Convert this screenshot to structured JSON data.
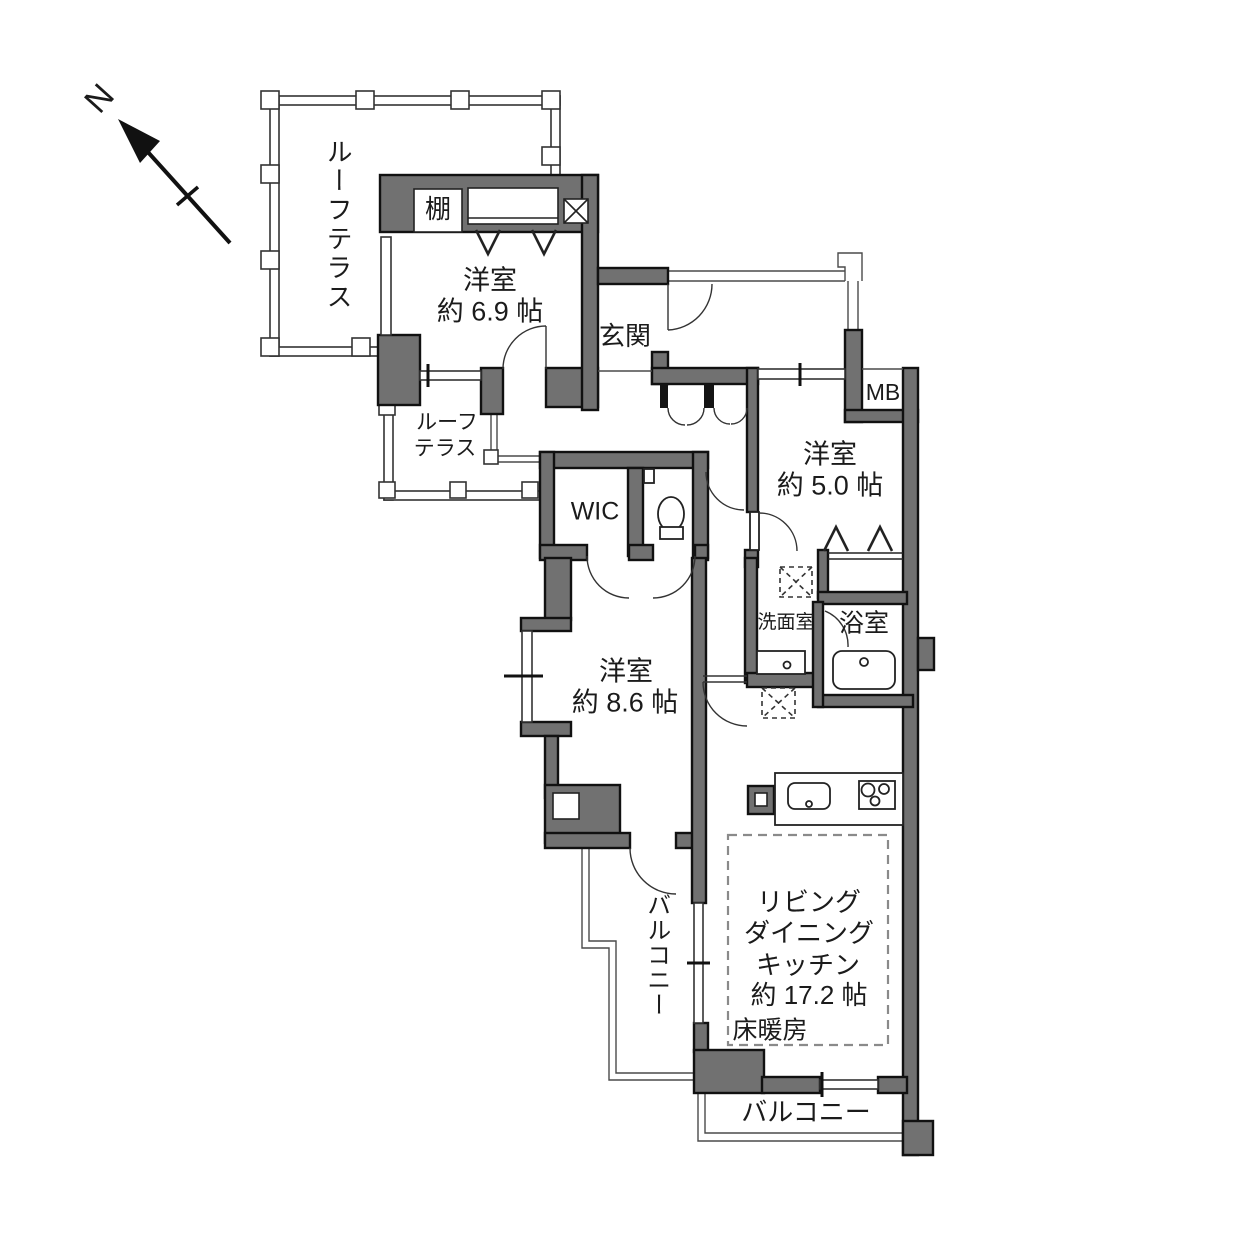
{
  "compass": {
    "north_label": "N"
  },
  "rooms": {
    "roof_terrace_main": {
      "label": "ルーフテラス"
    },
    "shelf": {
      "label": "棚"
    },
    "bedroom_69": {
      "name": "洋室",
      "area": "約 6.9 帖"
    },
    "entrance": {
      "label": "玄関"
    },
    "meter_box": {
      "label": "MB"
    },
    "bedroom_50": {
      "name": "洋室",
      "area": "約 5.0 帖"
    },
    "roof_terrace_sub": {
      "line1": "ルーフ",
      "line2": "テラス"
    },
    "walk_in_closet": {
      "label": "WIC"
    },
    "washroom": {
      "label": "洗面室"
    },
    "bathroom": {
      "label": "浴室"
    },
    "bedroom_86": {
      "name": "洋室",
      "area": "約 8.6 帖"
    },
    "balcony_west": {
      "label": "バルコニー"
    },
    "ldk": {
      "line1": "リビング",
      "line2": "ダイニング",
      "line3": "キッチン",
      "area": "約 17.2 帖"
    },
    "floor_heating": {
      "label": "床暖房"
    },
    "balcony_south": {
      "label": "バルコニー"
    }
  },
  "colors": {
    "wall_fill": "#717171",
    "wall_outline": "#111111",
    "background": "#ffffff",
    "thin_line": "#4a4a4a"
  }
}
